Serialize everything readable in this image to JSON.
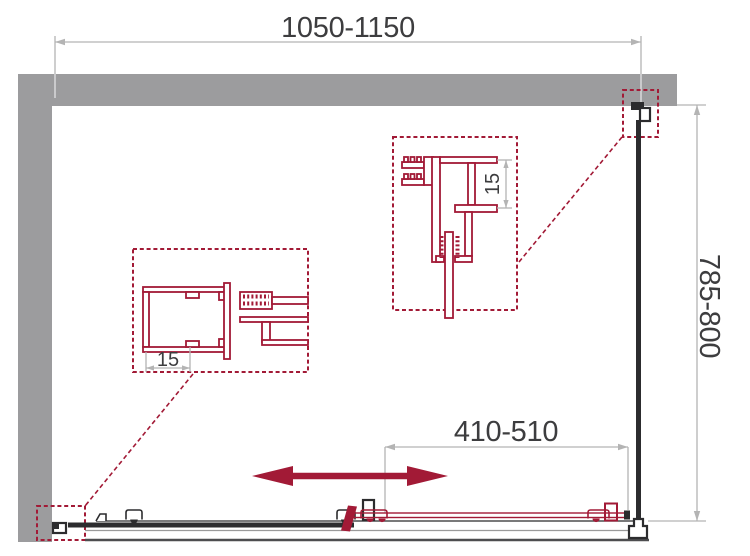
{
  "colors": {
    "wall": "#9c9c9e",
    "red": "#a21a36",
    "dimline": "#b4b4b4",
    "dimtext": "#3d3d3f",
    "dark": "#2c2c2e",
    "rail": "#4d4d4f",
    "tray": "#9a9a9a",
    "onwall": "#e4e4e4"
  },
  "diagram": {
    "labels": {
      "overall_width": "1050-1150",
      "depth": "785-800",
      "door_opening": "410-510",
      "detail_top_adjustment": "15",
      "detail_left_adjustment": "15"
    }
  }
}
